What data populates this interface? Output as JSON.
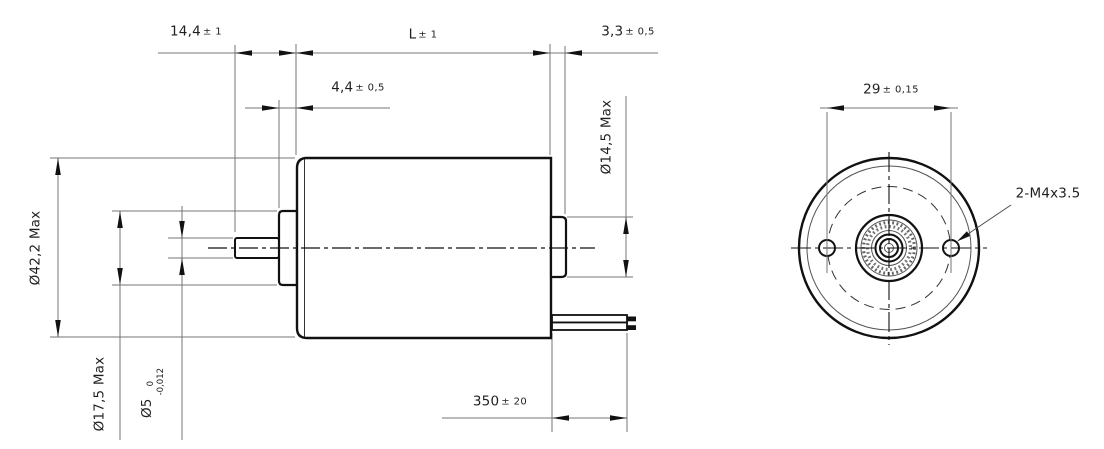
{
  "side_view": {
    "shaft_protrusion": {
      "value": "14,4",
      "tol": "± 1"
    },
    "body_length": {
      "value": "L",
      "tol": "± 1"
    },
    "rear_boss_length": {
      "value": "3,3",
      "tol": "± 0,5"
    },
    "front_boss_length": {
      "value": "4,4",
      "tol": "± 0,5"
    },
    "rear_boss_diameter": "Ø14,5 Max",
    "body_diameter": "Ø42,2 Max",
    "front_boss_diameter": "Ø17,5 Max",
    "shaft_diameter": {
      "value": "Ø5",
      "tol_upper": "0",
      "tol_lower": "-0,012"
    },
    "lead_wire_length": {
      "value": "350",
      "tol": "± 20"
    }
  },
  "front_view": {
    "mounting_hole_spacing": {
      "value": "29",
      "tol": "± 0,15"
    },
    "mounting_holes_label": "2-M4x3.5"
  },
  "colors": {
    "outline": "#111111",
    "dimension_line": "#757575",
    "text": "#1f1f1f"
  }
}
